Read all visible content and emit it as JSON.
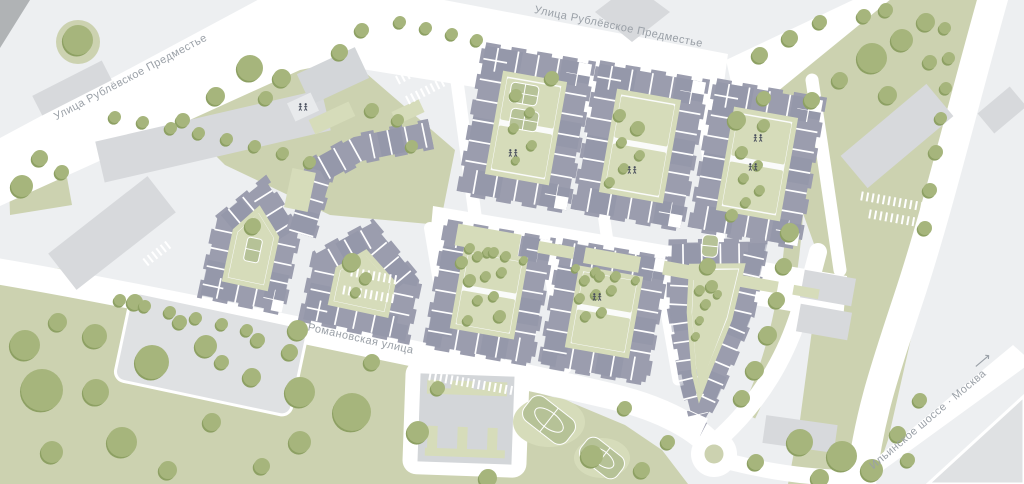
{
  "map": {
    "streets": {
      "rublevskoe": "Улица Рублёвское Предместье",
      "romanovskaya": "Романовская улица",
      "ilinskoe": "Ильинское шоссе · Москва",
      "ilinskoe_arrow": "⟶"
    },
    "icons": [
      "playground-icon",
      "direction-arrow-icon"
    ],
    "colors": {
      "background": "#edeff1",
      "road": "#ffffff",
      "greenery": "#ccd2b0",
      "greenery_light": "#d6dcba",
      "tree": "#a6b57c",
      "tree_shadow": "#8da063",
      "residential": "#9b9dae",
      "residential_shade": "#8f93a6",
      "building_gray": "#d7d9dc",
      "plaza": "#dfe1e3",
      "school": "#d3d6d9",
      "court": "#b6c297",
      "courtyard": "#fafbfa",
      "label": "#9aa0a7",
      "icon": "#474d5c",
      "corner": "#b0b3b5"
    }
  }
}
